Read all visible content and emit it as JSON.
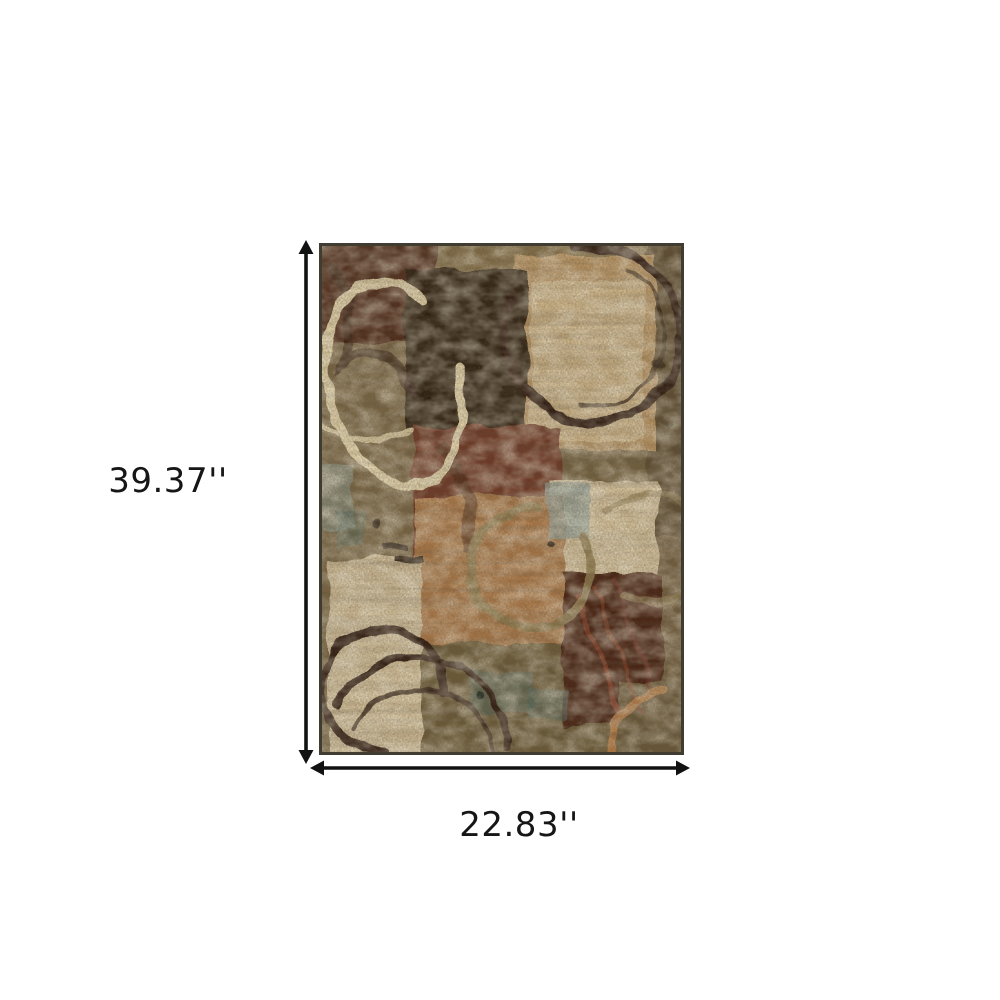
{
  "page": {
    "background_color": "#ffffff"
  },
  "dimension_diagram": {
    "height_label": "39.37''",
    "width_label": "22.83''",
    "arrow_color": "#121212",
    "label_color": "#161616"
  },
  "rug": {
    "name": "abstract-patchwork-area-rug",
    "description": "Abstract area rug with collaged color blocks and circular ring motifs in brown, rust, beige and olive tones",
    "border_color": "#413c32",
    "palette": {
      "base_olive": "#75633f",
      "top_band": "#86714a",
      "top_left_maroon": "#4e2617",
      "near_black_brown": "#2b1a0d",
      "tan_square": "#c09a66",
      "tan_square_inner": "#d6bf92",
      "right_strip": "#5e4d31",
      "right_strip_lower": "#756140",
      "left_olive": "#7b6844",
      "center_maroon": "#6f3520",
      "right_cream": "#dcc8a0",
      "bottom_left_beige": "#d8c59e",
      "center_orange": "#b27c49",
      "bottom_band": "#6d5b39",
      "bottom_right_maroon": "#451d10",
      "bottom_right_corner": "#6b5937",
      "blue_gray": "#93a7a3",
      "teal_speckle": "#54726a",
      "cream_ring": "#ecdcae",
      "dark_ring": "#2a190e",
      "olive_ring": "#94804f",
      "orange_ring": "#c28045",
      "rust_streak": "#8a3a20"
    }
  }
}
